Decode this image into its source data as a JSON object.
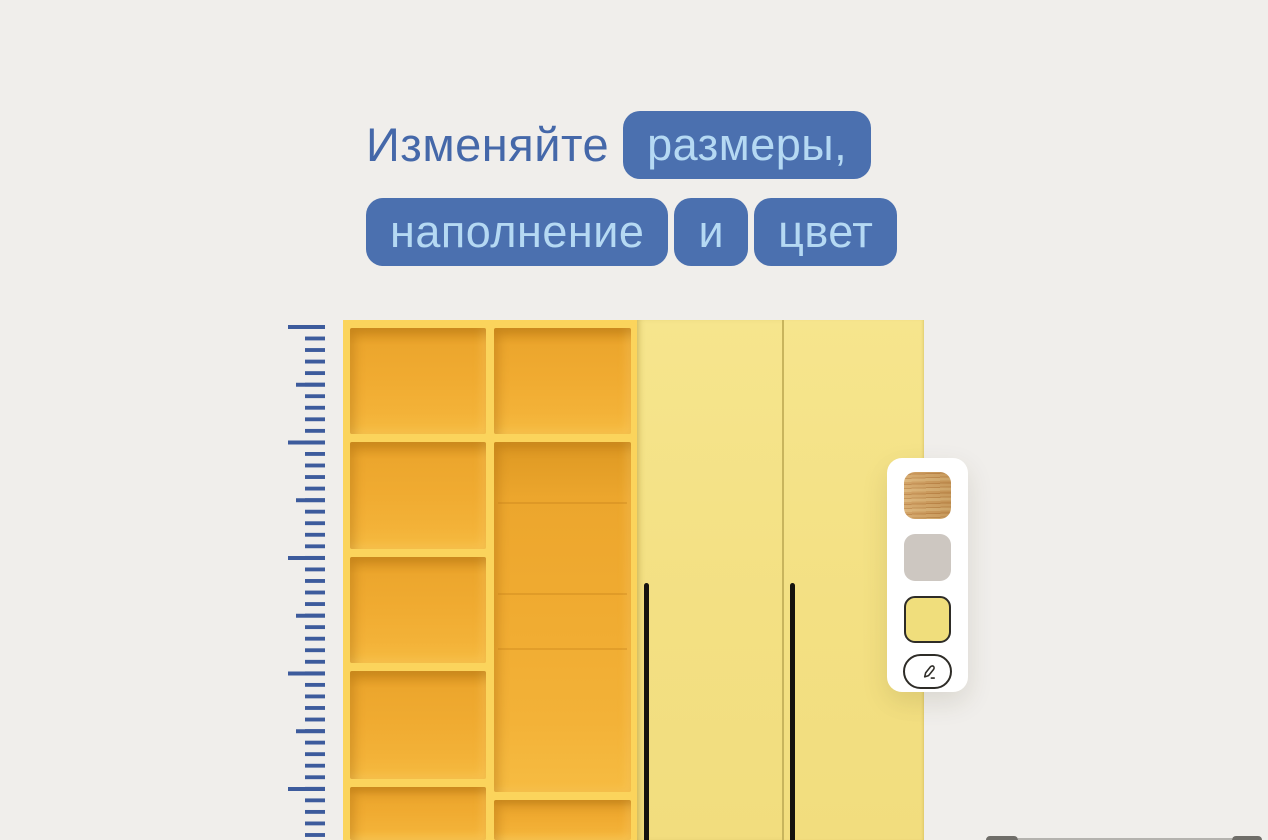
{
  "title": {
    "line1": {
      "plain": "Изменяйте",
      "pill": "размеры,"
    },
    "line2": {
      "pills": [
        "наполнение",
        "и",
        "цвет"
      ]
    }
  },
  "palette": {
    "swatches": [
      {
        "name": "wood-texture",
        "type": "texture",
        "base_color": "#C89455",
        "selected": false
      },
      {
        "name": "gray",
        "color": "#CDC7C1",
        "selected": false
      },
      {
        "name": "yellow",
        "color": "#F0DE7C",
        "selected": true
      }
    ],
    "edit_icon": "pencil"
  },
  "colors": {
    "background": "#F0EEEB",
    "title_text": "#4568A9",
    "pill_background": "#4B70AF",
    "pill_text": "#B5D9F3",
    "ruler_tick": "#3D5B9C",
    "wardrobe_frame": "#FBD45C",
    "wardrobe_interior": "#F0AB31",
    "wardrobe_doors": "#F3E083",
    "door_handle": "#15130E",
    "panel_background": "#FFFFFF",
    "swatch_border_selected": "#2E2C27"
  }
}
